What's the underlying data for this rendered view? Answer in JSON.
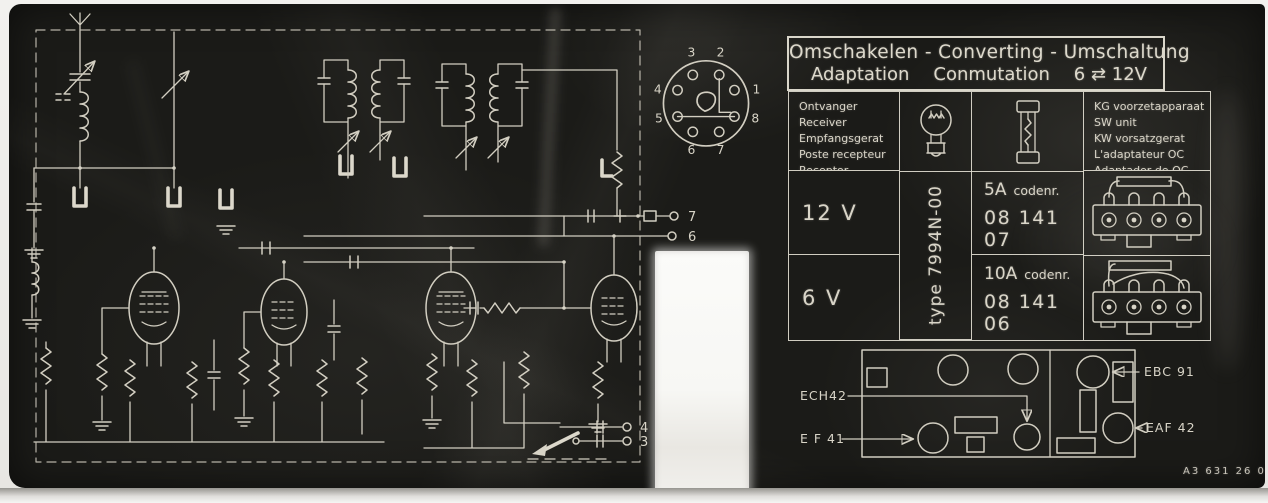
{
  "colors": {
    "plate_black": "#1b1b18",
    "ink_white": "#d8d4c7",
    "paper_white": "#f4f3f0"
  },
  "title": {
    "line1": "Omschakelen - Converting - Umschaltung",
    "line2_word1": "Adaptation",
    "line2_word2": "Conmutation",
    "line2_voltage": "6 ⇄ 12V"
  },
  "table": {
    "receiver": {
      "lines": [
        "Ontvanger",
        "Receiver",
        "Empfangsgerat",
        "Poste recepteur",
        "Receptor"
      ]
    },
    "sw_unit": {
      "lines": [
        "KG voorzetapparaat",
        "SW unit",
        "KW vorsatzgerat",
        "L'adaptateur OC",
        "Adaptador de OC"
      ]
    },
    "type_label": "type 7994N-00",
    "rows": [
      {
        "voltage": "12 V",
        "fuse_rating": "5A",
        "code_word": "codenr.",
        "code_number": "08 141 07"
      },
      {
        "voltage": "6 V",
        "fuse_rating": "10A",
        "code_word": "codenr.",
        "code_number": "08 141 06"
      }
    ]
  },
  "socket_pins": [
    "1",
    "2",
    "3",
    "4",
    "5",
    "6",
    "7",
    "8"
  ],
  "schematic_terminals": {
    "t7": "7",
    "t6": "6",
    "t4": "4",
    "t3": "3"
  },
  "chassis_labels": {
    "ech42": "ECH42",
    "ef41": "E F 41",
    "ebc91": "EBC 91",
    "eaf42": "EAF 42"
  },
  "footer": {
    "code": "A3 631 26 0"
  }
}
